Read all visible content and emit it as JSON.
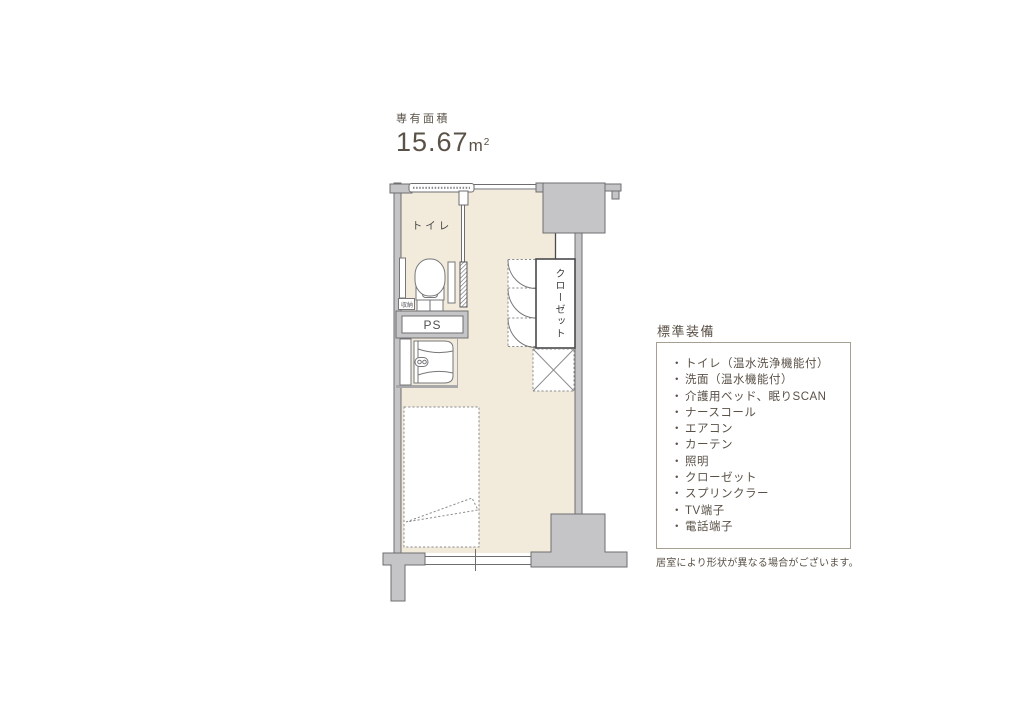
{
  "area": {
    "label": "専有面積",
    "value": "15.67",
    "unit": "m",
    "unit_sup": "2"
  },
  "floor_plan": {
    "labels": {
      "toilet": "トイレ",
      "ps": "PS",
      "storage": "収納",
      "closet": "クローゼット"
    },
    "colors": {
      "floor": "#f2ebdb",
      "wall_fill": "#c5c5c7",
      "wall_stroke": "#6e6e70",
      "line_gray": "#8c8c8e",
      "fixture_stroke": "#77777a",
      "closet_stroke": "#4a4a4c"
    }
  },
  "equipment": {
    "heading": "標準装備",
    "items": [
      {
        "bullet": "・",
        "label": "トイレ（温水洗浄機能付）"
      },
      {
        "bullet": "・",
        "label": "洗面（温水機能付）"
      },
      {
        "bullet": "・",
        "label": "介護用ベッド、眠りSCAN"
      },
      {
        "bullet": "・",
        "label": "ナースコール"
      },
      {
        "bullet": "・",
        "label": "エアコン"
      },
      {
        "bullet": "・",
        "label": "カーテン"
      },
      {
        "bullet": "・",
        "label": "照明"
      },
      {
        "bullet": "・",
        "label": "クローゼット"
      },
      {
        "bullet": "・",
        "label": "スプリンクラー"
      },
      {
        "bullet": "・",
        "label": "TV端子"
      },
      {
        "bullet": "・",
        "label": "電話端子"
      }
    ],
    "note": "居室により形状が異なる場合がございます。"
  },
  "text_color": "#5a5147"
}
